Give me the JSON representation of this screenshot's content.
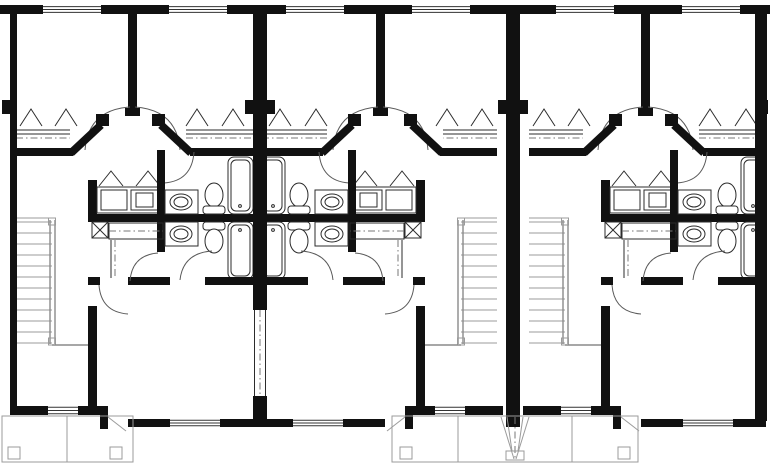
{
  "page": {
    "title": "Triplex Row House Floor Plan",
    "background": "#ffffff"
  },
  "drawing": {
    "type": "floor-plan",
    "building": "Three attached townhouse units, upper floor plan, black and white CAD line drawing",
    "units": [
      {
        "id": "unit-1",
        "label": "Unit 1 (left)",
        "mirrored": false
      },
      {
        "id": "unit-2",
        "label": "Unit 2 (middle)",
        "mirrored": true
      },
      {
        "id": "unit-3",
        "label": "Unit 3 (right)",
        "mirrored": false
      }
    ],
    "unit_contents": {
      "bedrooms": 2,
      "bathrooms": 2,
      "rooms": [
        "bedroom",
        "bedroom",
        "hall",
        "double vanity alcove",
        "bathroom",
        "bathroom",
        "linen closet",
        "laundry box",
        "staircase",
        "living room",
        "entry foyer",
        "front porch"
      ],
      "fixtures_per_unit": {
        "bathtubs": 2,
        "toilets": 2,
        "sink_basins": 2,
        "vanity_cabinets": 2,
        "closet_rod_shelves": 3,
        "shelf_bracket_symbols": 6,
        "stair_treads": 12,
        "rear_windows": 2,
        "front_windows": 2
      }
    },
    "porches": {
      "left_porch": {
        "posts": 2,
        "bays": 2
      },
      "center_shared_porch": {
        "posts": 2,
        "bays": 3,
        "steps": "tapered entry steps centered on party wall"
      }
    },
    "party_walls": 2,
    "colors": {
      "walls": "#111111",
      "fixture_lines": "#2b2b2b",
      "door_swings": "#5a5a5a",
      "light_lines": "#9b9b9b",
      "centerline": "#777777",
      "background": "#ffffff"
    }
  }
}
